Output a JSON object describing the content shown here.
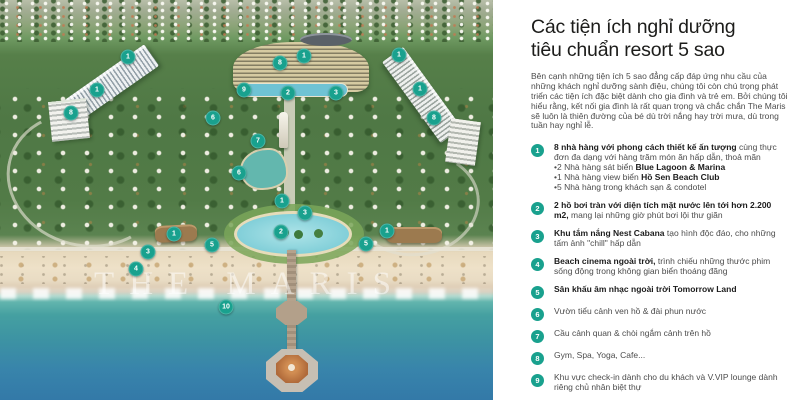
{
  "colors": {
    "accent": "#19a18e",
    "title": "#1c1c1a",
    "body_text": "#4c4c4c"
  },
  "panel": {
    "title_line1": "Các tiện ích nghỉ dưỡng",
    "title_line2": "tiêu chuẩn resort 5 sao",
    "intro": "Bên cạnh những tiện ích 5 sao đẳng cấp đáp ứng nhu cầu của những khách nghỉ dưỡng sành điệu, chúng tôi còn chú trọng phát triển các tiện ích đặc biệt dành cho gia đình và trẻ em. Bởi chúng tôi hiểu rằng, kết nối gia đình là rất quan trọng và chắc chắn The Maris sẽ luôn là thiên đường của bé dù trời nắng hay trời mưa, dù trong tuần hay nghỉ lễ.",
    "items": [
      {
        "num": "1",
        "parts": [
          {
            "b": 1,
            "t": "8 nhà hàng với phong cách thiết kế ấn tượng"
          },
          {
            "b": 0,
            "t": " cùng thực đơn đa dạng với hàng trăm món ăn hấp dẫn, thoả mãn"
          }
        ],
        "subs": [
          [
            {
              "b": 0,
              "t": "•2 Nhà hàng sát biển "
            },
            {
              "b": 1,
              "t": "Blue Lagoon & Marina"
            }
          ],
          [
            {
              "b": 0,
              "t": "•1 Nhà hàng view biển "
            },
            {
              "b": 1,
              "t": "Hồ Sen Beach Club"
            }
          ],
          [
            {
              "b": 0,
              "t": "•5 Nhà hàng trong khách sạn & condotel"
            }
          ]
        ]
      },
      {
        "num": "2",
        "parts": [
          {
            "b": 1,
            "t": "2 hồ bơi tràn với diện tích mặt nước lên tới hơn 2.200 m2,"
          },
          {
            "b": 0,
            "t": " mang lại những giờ phút bơi lội thư giãn"
          }
        ]
      },
      {
        "num": "3",
        "parts": [
          {
            "b": 1,
            "t": "Khu tắm nắng Nest Cabana"
          },
          {
            "b": 0,
            "t": " tạo hình độc đáo, cho những tấm ảnh \"chill\" hấp dẫn"
          }
        ]
      },
      {
        "num": "4",
        "parts": [
          {
            "b": 1,
            "t": "Beach cinema ngoài trời,"
          },
          {
            "b": 0,
            "t": " trình chiếu những thước phim sống động trong không gian biển thoáng đãng"
          }
        ]
      },
      {
        "num": "5",
        "parts": [
          {
            "b": 1,
            "t": "Sân khấu âm nhạc ngoài trời Tomorrow Land"
          }
        ]
      },
      {
        "num": "6",
        "parts": [
          {
            "b": 0,
            "t": "Vườn tiểu cảnh ven hồ & đài phun nước"
          }
        ]
      },
      {
        "num": "7",
        "parts": [
          {
            "b": 0,
            "t": "Cầu cảnh quan & chòi ngắm cảnh trên hồ"
          }
        ]
      },
      {
        "num": "8",
        "parts": [
          {
            "b": 0,
            "t": "Gym, Spa, Yoga, Cafe..."
          }
        ]
      },
      {
        "num": "9",
        "parts": [
          {
            "b": 0,
            "t": "Khu vực check-in dành cho du khách và V.VIP lounge dành riêng chủ nhân biệt thự"
          }
        ]
      },
      {
        "num": "10",
        "parts": [
          {
            "b": 1,
            "t": "Khu thể thao biển Water Sports"
          },
          {
            "b": 0,
            "t": " với vô số hoạt động thể thao dưới nước cực kì thú vị"
          }
        ]
      }
    ]
  },
  "map": {
    "watermark": "THE MARIS",
    "markers": [
      {
        "n": "1",
        "x": 128,
        "y": 57
      },
      {
        "n": "8",
        "x": 280,
        "y": 63
      },
      {
        "n": "1",
        "x": 304,
        "y": 56
      },
      {
        "n": "1",
        "x": 399,
        "y": 55
      },
      {
        "n": "1",
        "x": 97,
        "y": 90
      },
      {
        "n": "9",
        "x": 244,
        "y": 90
      },
      {
        "n": "2",
        "x": 288,
        "y": 93
      },
      {
        "n": "3",
        "x": 336,
        "y": 93
      },
      {
        "n": "1",
        "x": 420,
        "y": 89
      },
      {
        "n": "8",
        "x": 71,
        "y": 113
      },
      {
        "n": "6",
        "x": 213,
        "y": 118
      },
      {
        "n": "8",
        "x": 434,
        "y": 118
      },
      {
        "n": "7",
        "x": 258,
        "y": 141
      },
      {
        "n": "6",
        "x": 239,
        "y": 173
      },
      {
        "n": "1",
        "x": 282,
        "y": 201
      },
      {
        "n": "3",
        "x": 305,
        "y": 213
      },
      {
        "n": "2",
        "x": 281,
        "y": 232
      },
      {
        "n": "1",
        "x": 174,
        "y": 234
      },
      {
        "n": "1",
        "x": 387,
        "y": 231
      },
      {
        "n": "5",
        "x": 212,
        "y": 245
      },
      {
        "n": "5",
        "x": 366,
        "y": 244
      },
      {
        "n": "3",
        "x": 148,
        "y": 252
      },
      {
        "n": "4",
        "x": 136,
        "y": 269
      },
      {
        "n": "10",
        "x": 226,
        "y": 307
      }
    ]
  }
}
